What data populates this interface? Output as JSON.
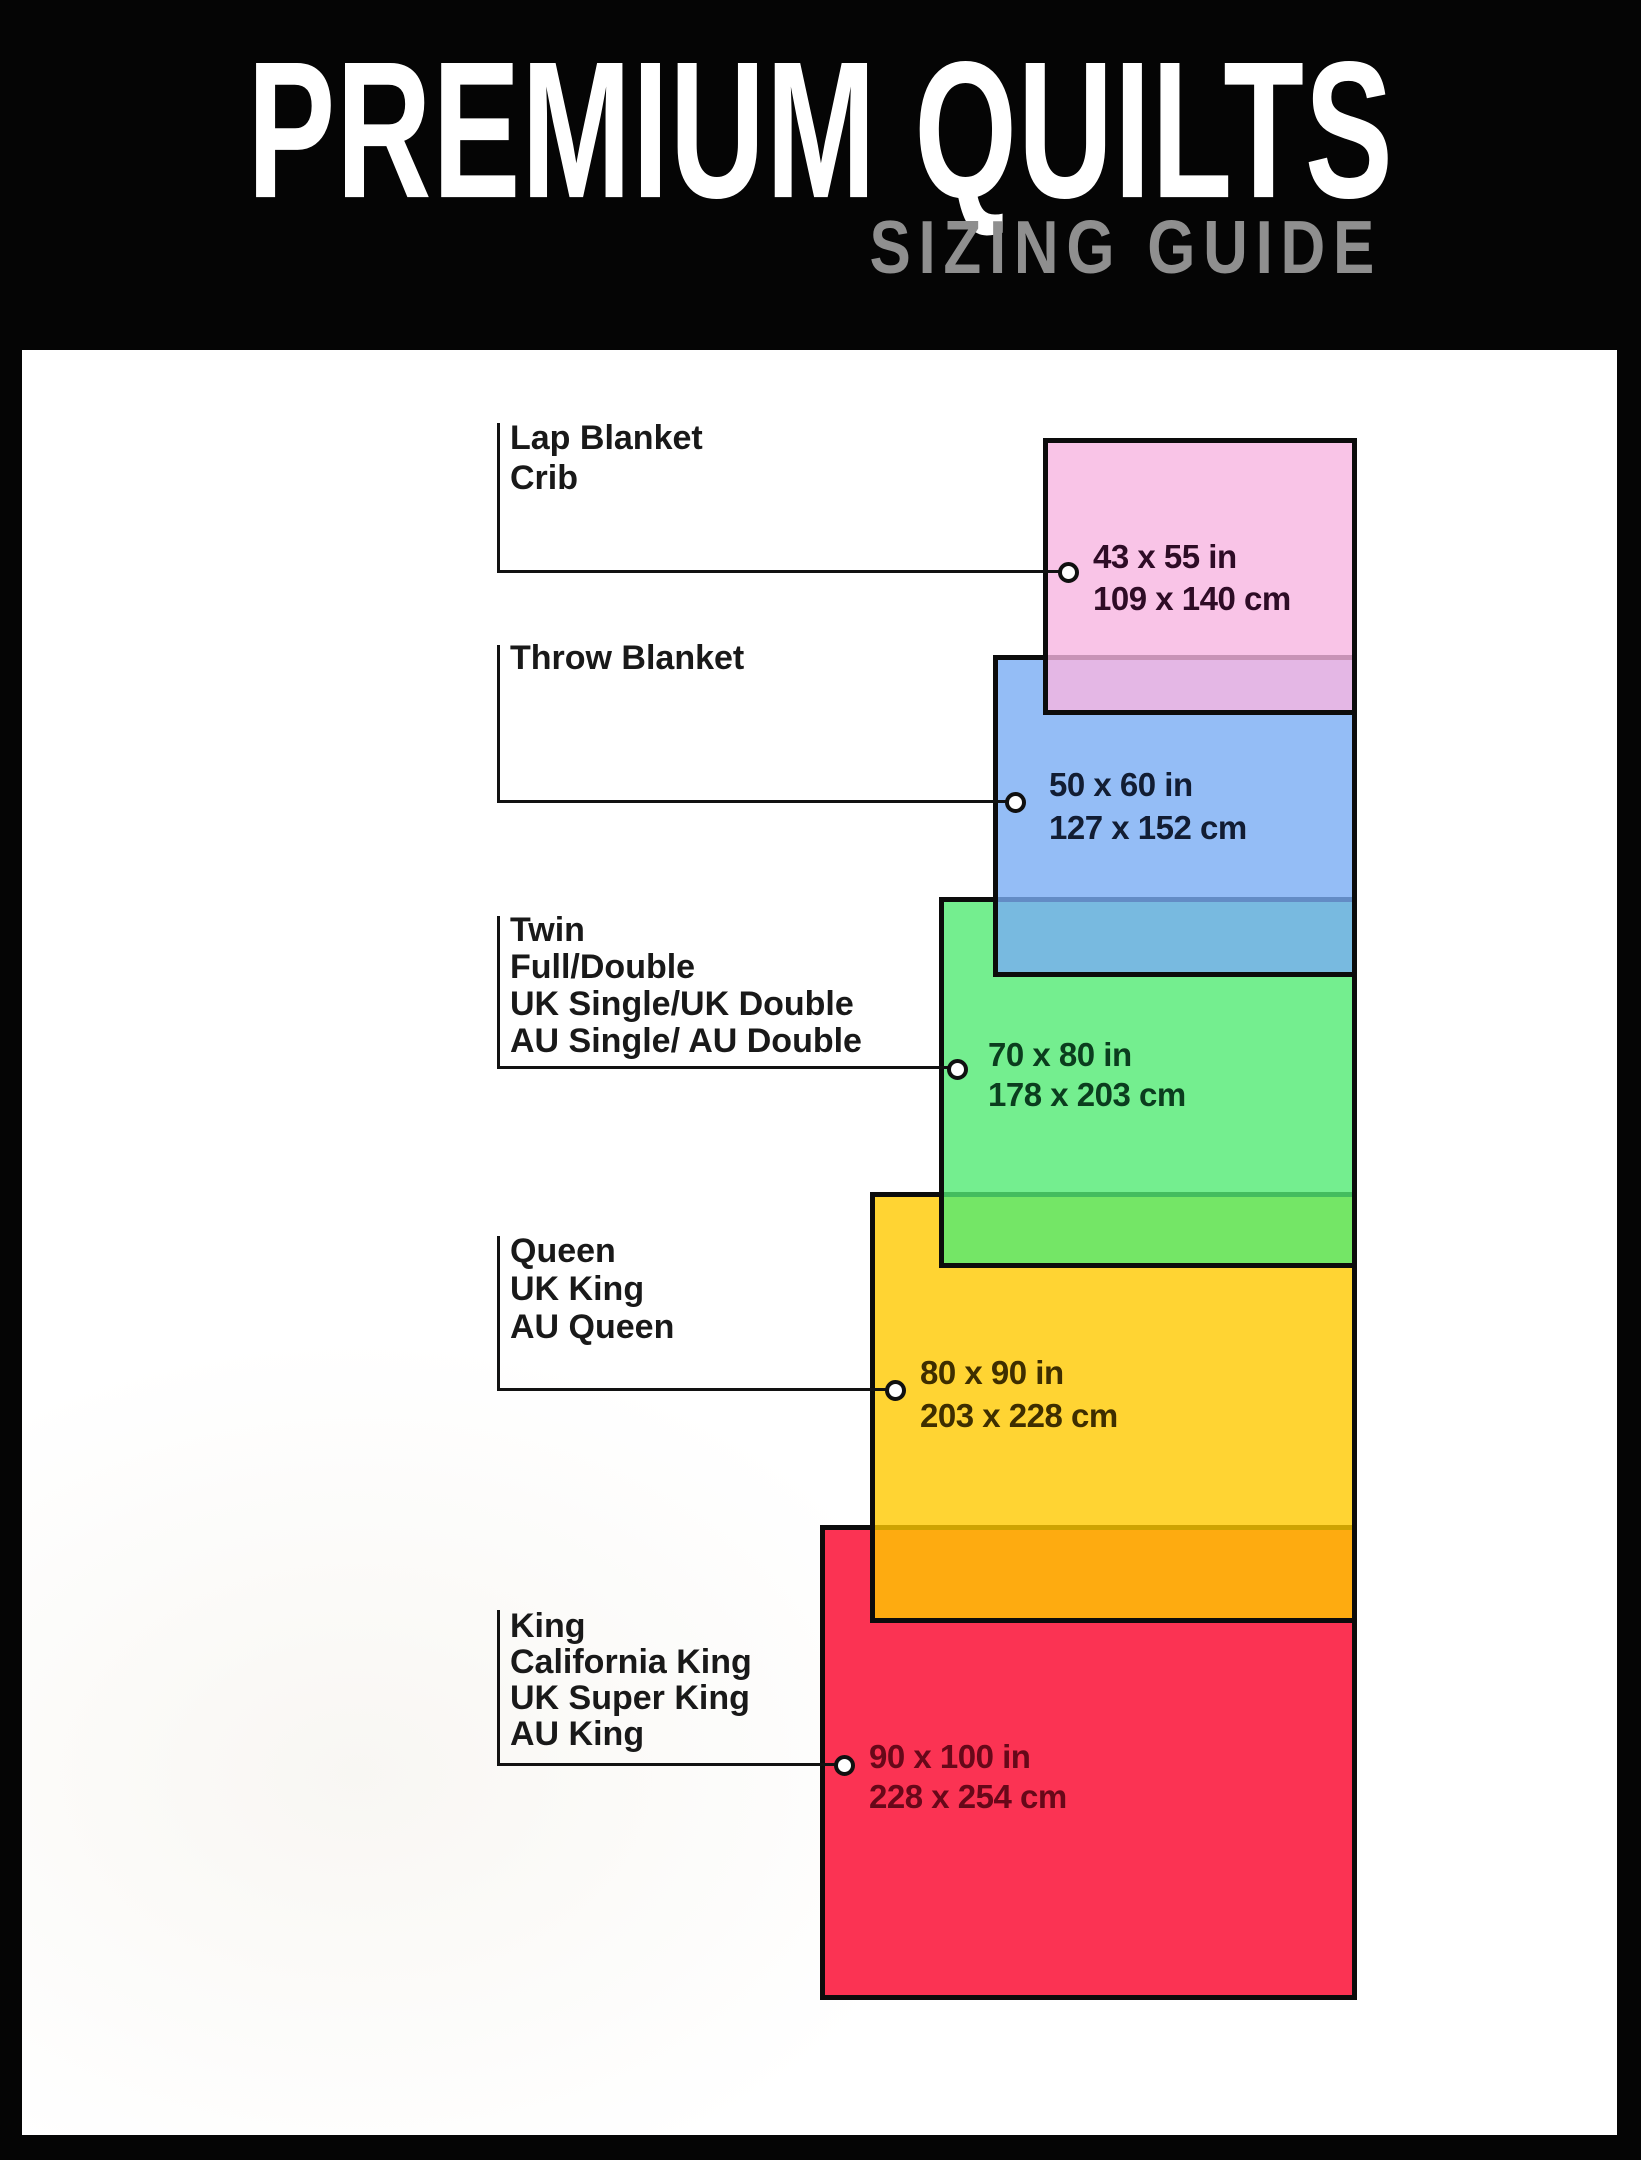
{
  "header": {
    "title": "PREMIUM QUILTS",
    "subtitle": "SIZING GUIDE",
    "background": "#050505",
    "title_color": "#ffffff",
    "subtitle_color": "#8f8f8f"
  },
  "sizes": [
    {
      "id": "lap",
      "labels": [
        "Lap Blanket",
        "Crib"
      ],
      "imperial": "43 x 55 in",
      "metric": "109 x 140 cm",
      "fill_color": "#f9c4e7",
      "text_color": "#2e0c26"
    },
    {
      "id": "throw",
      "labels": [
        "Throw Blanket"
      ],
      "imperial": "50 x 60 in",
      "metric": "127 x 152 cm",
      "fill_color": "#94bdf6",
      "text_color": "#121d33"
    },
    {
      "id": "twin",
      "labels": [
        "Twin",
        "Full/Double",
        "UK Single/UK Double",
        "AU Single/ AU Double"
      ],
      "imperial": "70 x 80 in",
      "metric": "178 x 203 cm",
      "fill_color": "#74ee8f",
      "text_color": "#0b3d1e"
    },
    {
      "id": "queen",
      "labels": [
        "Queen",
        "UK King",
        "AU Queen"
      ],
      "imperial": "80 x 90 in",
      "metric": "203 x 228 cm",
      "fill_color": "#ffd401",
      "text_color": "#3e2e00"
    },
    {
      "id": "king",
      "labels": [
        "King",
        "California King",
        "UK Super King",
        "AU King"
      ],
      "imperial": "90 x 100 in",
      "metric": "228 x 254 cm",
      "fill_color": "#fb2b53",
      "text_color": "#670819"
    }
  ]
}
